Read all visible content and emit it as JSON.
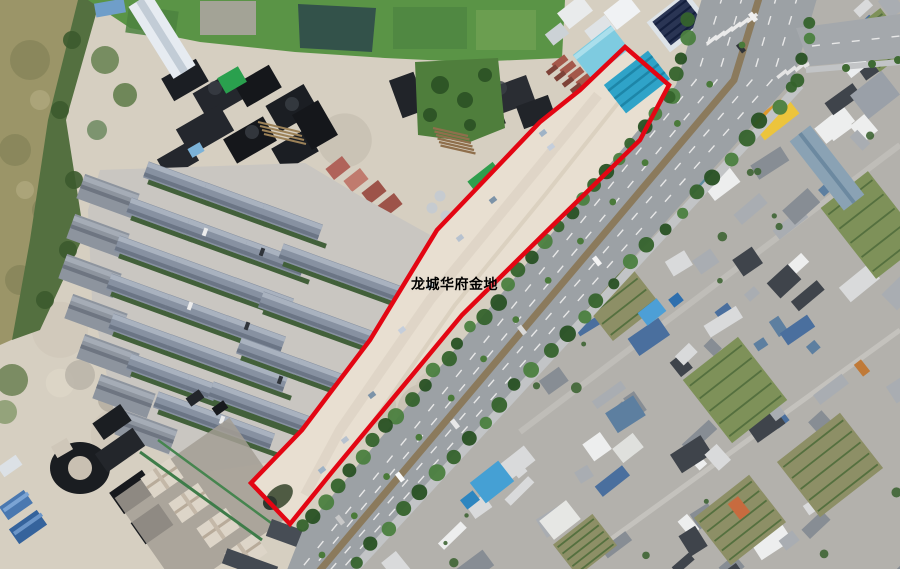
{
  "scene": {
    "description": "Aerial orthophoto (satellite/drone survey image) of a development area: muddy river bank and farm fields top-left, coal stockpiles, a townhouse estate under construction, a long cleared land parcel outlined in red beside a tree-lined arterial road, dense urban village fabric to the east",
    "width_px": 900,
    "height_px": 569
  },
  "annotation": {
    "parcel_label": "龙城华府金地",
    "label_color": "#000000",
    "label_x": 411,
    "label_y": 274,
    "outline_color": "#e30613",
    "outline_width": 4.5,
    "parcel_points": "625,47 669,85 640,140 548,230 462,315 332,472 290,524 251,483 302,430 370,340 437,230 540,122 580,90"
  },
  "palette": {
    "sand": "#d6cfc1",
    "parcel_sand": "#e8dfd1",
    "road_asphalt": "#9ca1a5",
    "median_dirt": "#8b7a5c",
    "sidewalk": "#c2c4c6",
    "lane_marking": "#e8e8e8",
    "tree_green": "#3f6b33",
    "field_green": "#5a9446",
    "pond_dark": "#33524a",
    "water_olive": "#9b9568",
    "bank_green": "#547040",
    "coal_black": "#1d2024",
    "estate_roof_slate": "#8791a1",
    "hedge_green": "#42603a",
    "construction_red": "#b0635a",
    "roof_blue": "#2fa3c8",
    "roof_yellow": "#ecc43c",
    "urban_concrete": "#b3b1ac",
    "garden_green": "#7e9159"
  }
}
